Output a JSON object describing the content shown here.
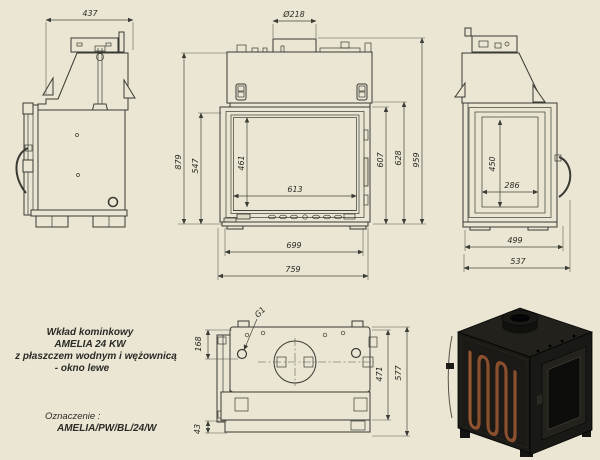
{
  "colors": {
    "background": "#eae6d3",
    "drawing_line": "#3a3a34",
    "dimension_line": "#44443e",
    "text": "#2b2b26",
    "render_body": "#1b1a16",
    "render_coil": "#8a4f2c"
  },
  "title_block": {
    "line1": "Wkład kominkowy",
    "line2": "AMELIA 24 KW",
    "line3": "z płaszczem wodnym i wężownicą",
    "line4": "- okno lewe",
    "designation_label": "Oznaczenie :",
    "designation_value": "AMELIA/PW/BL/24/W"
  },
  "dimensions": {
    "side_left": {
      "top_width": "437"
    },
    "front": {
      "flue_diameter": "Ø218",
      "total_height": "959",
      "body_height": "879",
      "frame_height": "628",
      "door_height": "607",
      "glass_frame_height": "547",
      "glass_height": "461",
      "glass_width": "613",
      "door_width": "699",
      "total_width": "759"
    },
    "side_right": {
      "glass_height": "450",
      "glass_width": "286",
      "body_depth": "499",
      "total_depth": "537"
    },
    "top_view": {
      "flue_offset": "168",
      "base_ledge": "43",
      "inner_depth": "471",
      "total_depth": "577",
      "thread_label": "G1"
    }
  }
}
